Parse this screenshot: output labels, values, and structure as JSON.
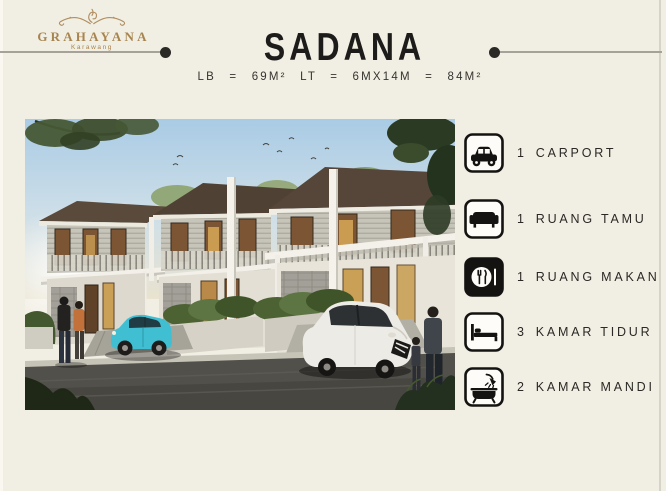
{
  "slide": {
    "background_color": "#f1eee3",
    "edge_color": "#d6d3c8"
  },
  "brand": {
    "name": "GRAHAYANA",
    "location": "Karawang",
    "color": "#a8854f",
    "ornament_icon": "flourish-icon"
  },
  "header": {
    "title": "SADANA",
    "specs": "LB = 69M² LT = 6MX14M = 84M²",
    "divider_line_color": "#a6a29a",
    "divider_dot_color": "#2b2a27"
  },
  "photo": {
    "description": "Architectural rendering of a row of modern two-storey terrace houses with carports, a teal hatchback and a white SUV parked, residents walking along the street"
  },
  "features": [
    {
      "icon": "car-icon",
      "qty": "1",
      "label": "CARPORT"
    },
    {
      "icon": "sofa-icon",
      "qty": "1",
      "label": "RUANG TAMU"
    },
    {
      "icon": "dining-icon",
      "qty": "1",
      "label": "RUANG MAKAN"
    },
    {
      "icon": "bed-icon",
      "qty": "3",
      "label": "KAMAR TIDUR"
    },
    {
      "icon": "bath-icon",
      "qty": "2",
      "label": "KAMAR MANDI"
    }
  ]
}
